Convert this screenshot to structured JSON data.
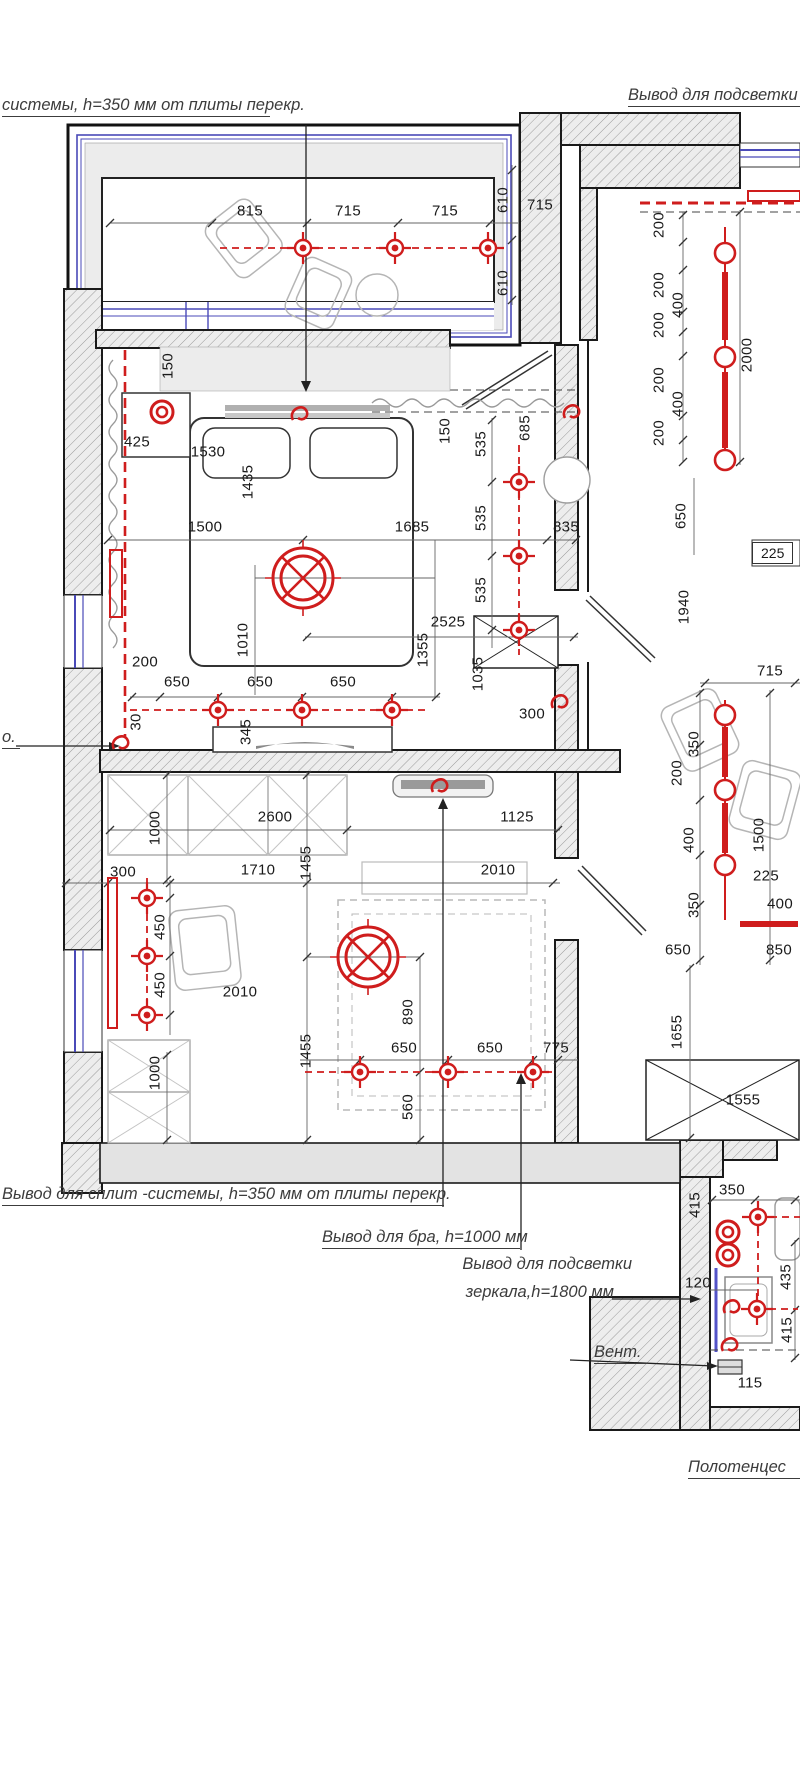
{
  "colors": {
    "accent_red": "#cf1d1d",
    "window_blue": "#4a4ab8",
    "wall_gray": "#ededed",
    "line_dark": "#1a1a1a"
  },
  "annotations": [
    {
      "id": "split-system-top",
      "text": "системы, h=350 мм от плиты перекр.",
      "x": 2,
      "y": 96,
      "w": 268,
      "underline": true,
      "align": "left"
    },
    {
      "id": "backlight-top",
      "text": "Вывод для подсветки",
      "x": 628,
      "y": 86,
      "w": 172,
      "underline": true,
      "align": "left"
    },
    {
      "id": "left-fragment",
      "text": "о.",
      "x": 2,
      "y": 728,
      "w": 18,
      "underline": true,
      "align": "left"
    },
    {
      "id": "split-system-bottom",
      "text": "Вывод  для сплит -системы, h=350 мм от плиты перекр.",
      "x": 2,
      "y": 1185,
      "w": 442,
      "underline": true,
      "align": "left"
    },
    {
      "id": "sconce",
      "text": "Вывод  для бра, h=1000 мм",
      "x": 322,
      "y": 1228,
      "w": 198,
      "underline": true,
      "align": "left"
    },
    {
      "id": "mirror-light-1",
      "text": "Вывод для подсветки",
      "x": 398,
      "y": 1255,
      "w": 234,
      "underline": false,
      "align": "right"
    },
    {
      "id": "mirror-light-2",
      "text": "зеркала,h=1800 мм",
      "x": 398,
      "y": 1283,
      "w": 216,
      "underline": false,
      "align": "right"
    },
    {
      "id": "vent",
      "text": "Вент.",
      "x": 594,
      "y": 1343,
      "w": 54,
      "underline": true,
      "align": "left"
    },
    {
      "id": "towel-dryer",
      "text": "Полотенцес",
      "x": 688,
      "y": 1458,
      "w": 112,
      "underline": true,
      "align": "left"
    }
  ],
  "boxed_dims": [
    {
      "t": "225",
      "x": 752,
      "y": 553
    }
  ],
  "dims": [
    [
      250,
      211,
      0,
      "815"
    ],
    [
      348,
      211,
      0,
      "715"
    ],
    [
      445,
      211,
      0,
      "715"
    ],
    [
      503,
      200,
      1,
      "610"
    ],
    [
      540,
      205,
      0,
      "715"
    ],
    [
      503,
      283,
      1,
      "610"
    ],
    [
      659,
      225,
      1,
      "200"
    ],
    [
      659,
      285,
      1,
      "200"
    ],
    [
      678,
      305,
      1,
      "400"
    ],
    [
      659,
      325,
      1,
      "200"
    ],
    [
      659,
      380,
      1,
      "200"
    ],
    [
      678,
      404,
      1,
      "400"
    ],
    [
      659,
      433,
      1,
      "200"
    ],
    [
      747,
      355,
      1,
      "2000"
    ],
    [
      681,
      516,
      1,
      "650"
    ],
    [
      168,
      366,
      1,
      "150"
    ],
    [
      137,
      442,
      0,
      "425"
    ],
    [
      208,
      452,
      0,
      "1530"
    ],
    [
      248,
      482,
      1,
      "1435"
    ],
    [
      445,
      431,
      1,
      "150"
    ],
    [
      525,
      428,
      1,
      "685"
    ],
    [
      481,
      444,
      1,
      "535"
    ],
    [
      481,
      518,
      1,
      "535"
    ],
    [
      481,
      590,
      1,
      "535"
    ],
    [
      205,
      527,
      0,
      "1500"
    ],
    [
      412,
      527,
      0,
      "1685"
    ],
    [
      566,
      527,
      0,
      "835"
    ],
    [
      448,
      622,
      0,
      "2525"
    ],
    [
      243,
      640,
      1,
      "1010"
    ],
    [
      423,
      650,
      1,
      "1355"
    ],
    [
      478,
      674,
      1,
      "1035"
    ],
    [
      145,
      662,
      0,
      "200"
    ],
    [
      177,
      682,
      0,
      "650"
    ],
    [
      260,
      682,
      0,
      "650"
    ],
    [
      343,
      682,
      0,
      "650"
    ],
    [
      136,
      722,
      1,
      "30"
    ],
    [
      246,
      732,
      1,
      "345"
    ],
    [
      684,
      607,
      1,
      "1940"
    ],
    [
      770,
      671,
      0,
      "715"
    ],
    [
      677,
      773,
      1,
      "200"
    ],
    [
      694,
      744,
      1,
      "350"
    ],
    [
      689,
      840,
      1,
      "400"
    ],
    [
      759,
      835,
      1,
      "1500"
    ],
    [
      766,
      876,
      0,
      "225"
    ],
    [
      780,
      904,
      0,
      "400"
    ],
    [
      694,
      905,
      1,
      "350"
    ],
    [
      678,
      950,
      0,
      "650"
    ],
    [
      779,
      950,
      0,
      "850"
    ],
    [
      677,
      1032,
      1,
      "1655"
    ],
    [
      743,
      1100,
      0,
      "1555"
    ],
    [
      275,
      817,
      0,
      "2600"
    ],
    [
      517,
      817,
      0,
      "1125"
    ],
    [
      155,
      828,
      1,
      "1000"
    ],
    [
      123,
      872,
      0,
      "300"
    ],
    [
      258,
      870,
      0,
      "1710"
    ],
    [
      306,
      863,
      1,
      "1455"
    ],
    [
      498,
      870,
      0,
      "2010"
    ],
    [
      160,
      927,
      1,
      "450"
    ],
    [
      160,
      985,
      1,
      "450"
    ],
    [
      240,
      992,
      0,
      "2010"
    ],
    [
      408,
      1012,
      1,
      "890"
    ],
    [
      306,
      1051,
      1,
      "1455"
    ],
    [
      155,
      1073,
      1,
      "1000"
    ],
    [
      404,
      1048,
      0,
      "650"
    ],
    [
      490,
      1048,
      0,
      "650"
    ],
    [
      556,
      1048,
      0,
      "775"
    ],
    [
      408,
      1107,
      1,
      "560"
    ],
    [
      532,
      714,
      0,
      "300"
    ],
    [
      732,
      1190,
      0,
      "350"
    ],
    [
      695,
      1205,
      1,
      "415"
    ],
    [
      698,
      1283,
      0,
      "120"
    ],
    [
      786,
      1277,
      1,
      "435"
    ],
    [
      787,
      1330,
      1,
      "415"
    ],
    [
      750,
      1383,
      0,
      "115"
    ]
  ],
  "symbols": {
    "chandeliers": [
      [
        303,
        578
      ],
      [
        368,
        957
      ]
    ],
    "outlets": [
      [
        303,
        248
      ],
      [
        395,
        248
      ],
      [
        488,
        248
      ],
      [
        519,
        482
      ],
      [
        519,
        556
      ],
      [
        519,
        630
      ],
      [
        218,
        710
      ],
      [
        302,
        710
      ],
      [
        392,
        710
      ],
      [
        147,
        898
      ],
      [
        147,
        956
      ],
      [
        147,
        1015
      ],
      [
        360,
        1072
      ],
      [
        448,
        1072
      ],
      [
        533,
        1072
      ],
      [
        758,
        1217
      ],
      [
        757,
        1309
      ]
    ],
    "spots": [
      [
        162,
        412
      ],
      [
        728,
        1232
      ],
      [
        728,
        1255
      ]
    ],
    "track_circles": [
      [
        725,
        253
      ],
      [
        725,
        357
      ],
      [
        725,
        460
      ],
      [
        725,
        715
      ],
      [
        725,
        790
      ],
      [
        725,
        865
      ]
    ],
    "hooks": [
      [
        300,
        414
      ],
      [
        121,
        743
      ],
      [
        440,
        786
      ],
      [
        560,
        702
      ],
      [
        572,
        412
      ],
      [
        732,
        1307
      ],
      [
        730,
        1345
      ]
    ]
  }
}
